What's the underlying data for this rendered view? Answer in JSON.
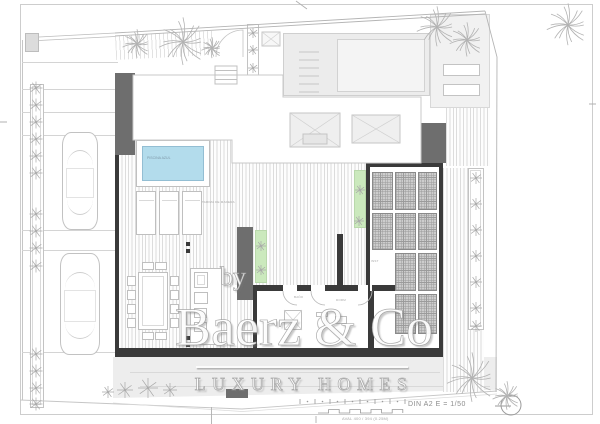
{
  "watermark": {
    "prefix": "by",
    "brand": "Baerz & Co",
    "tagline": "LUXURY HOMES"
  },
  "titleblock": {
    "scale_note": "DIN A2  E = 1/50",
    "footer_note": "AVAL 400 / 394 (0.25M)"
  },
  "plan": {
    "pool_label": "PISCINA AZUL",
    "deck_note": "TARIMA DE MADERA",
    "room_labels": [
      "BAÑO",
      "DORM"
    ],
    "pergola_label": "INST"
  },
  "colors": {
    "pool_blue": "#b3dcec",
    "planter_green": "#cbe9bd",
    "wall_dark": "#3a3a3a",
    "paper": "#ffffff"
  }
}
